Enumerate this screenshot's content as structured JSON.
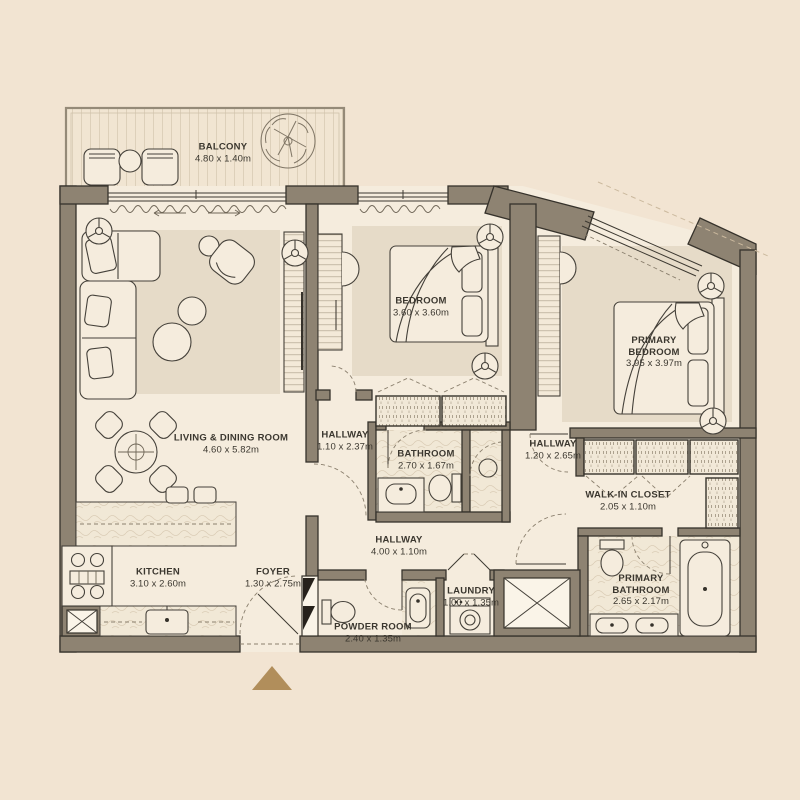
{
  "colors": {
    "background": "#f2e4d2",
    "floor": "#f5ecdd",
    "wall": "#8e8372",
    "outline": "#36322b",
    "rug": "#e6dbc8",
    "label_text": "#3b372f",
    "entrance_marker": "#b18e5b"
  },
  "rooms": {
    "balcony": {
      "name": "BALCONY",
      "dims": "4.80 x 1.40m"
    },
    "living_dining": {
      "name": "LIVING & DINING ROOM",
      "dims": "4.60 x 5.82m"
    },
    "bedroom": {
      "name": "BEDROOM",
      "dims": "3.60 x 3.60m"
    },
    "primary_bedroom": {
      "name": "PRIMARY BEDROOM",
      "dims": "3.95 x 3.97m"
    },
    "hallway_bedroom": {
      "name": "HALLWAY",
      "dims": "1.10 x 2.37m"
    },
    "bathroom": {
      "name": "BATHROOM",
      "dims": "2.70 x 1.67m"
    },
    "hallway_primary": {
      "name": "HALLWAY",
      "dims": "1.20 x 2.65m"
    },
    "walk_in_closet": {
      "name": "WALK-IN CLOSET",
      "dims": "2.05 x 1.10m"
    },
    "kitchen": {
      "name": "KITCHEN",
      "dims": "3.10 x 2.60m"
    },
    "foyer": {
      "name": "FOYER",
      "dims": "1.30 x 2.75m"
    },
    "hallway_main": {
      "name": "HALLWAY",
      "dims": "4.00 x 1.10m"
    },
    "powder_room": {
      "name": "POWDER ROOM",
      "dims": "2.40 x 1.35m"
    },
    "laundry": {
      "name": "LAUNDRY",
      "dims": "1.00 x 1.35m"
    },
    "primary_bathroom": {
      "name": "PRIMARY BATHROOM",
      "dims": "2.65 x 2.17m"
    }
  }
}
